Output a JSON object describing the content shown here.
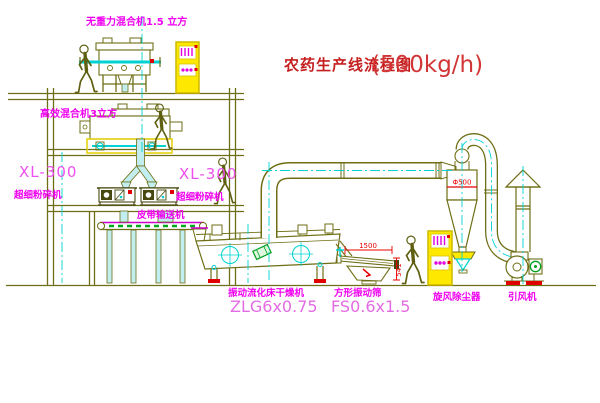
{
  "title": {
    "text": "农药生产线流程图",
    "capacity": "(500kg/h)"
  },
  "labels": {
    "mixer_top": "无重力混合机1.5 立方",
    "mixer_mid": "高效混合机3立方",
    "crusher_left_model": "XL-300",
    "crusher_left_name": "超细粉碎机",
    "crusher_right_model": "XL-300",
    "crusher_right_name": "超细粉碎机",
    "belt_conveyor": "皮带输送机",
    "dryer_name": "振动流化床干燥机",
    "dryer_model": "ZLG6x0.75",
    "screen_name": "方形振动筛",
    "screen_model": "FS0.6x1.5",
    "cyclone_name": "旋风除尘器",
    "fan_name": "引风机"
  },
  "dimensions": {
    "screen_length": "1500",
    "screen_height": "541",
    "cyclone_diameter": "Φ500"
  },
  "colors": {
    "line_olive": "#6e6e15",
    "centerline_cyan": "#00d2d2",
    "label_magenta": "#f000f0",
    "model_pink": "#e36be3",
    "dimension_red": "#e80000",
    "title_red": "#c51f1f",
    "cabinet_yellow": "#ffe800",
    "belt_green": "#00a820"
  }
}
